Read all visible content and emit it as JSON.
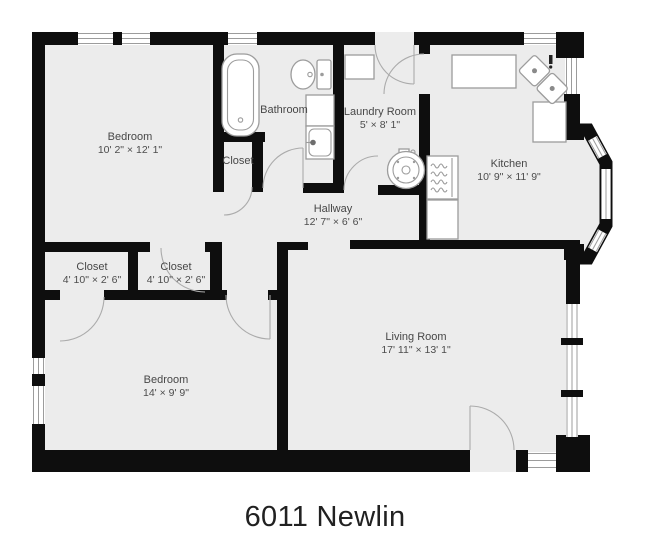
{
  "title": "6011 Newlin",
  "rooms": {
    "bedroom1": {
      "name": "Bedroom",
      "dims": "10' 2\" × 12' 1\""
    },
    "bathroom": {
      "name": "Bathroom",
      "dims": ""
    },
    "closet_top": {
      "name": "Closet",
      "dims": ""
    },
    "laundry": {
      "name": "Laundry Room",
      "dims": "5' × 8' 1\""
    },
    "kitchen": {
      "name": "Kitchen",
      "dims": "10' 9\" × 11' 9\""
    },
    "hallway": {
      "name": "Hallway",
      "dims": "12' 7\" × 6' 6\""
    },
    "closet_left": {
      "name": "Closet",
      "dims": "4' 10\" × 2' 6\""
    },
    "closet_mid": {
      "name": "Closet",
      "dims": "4' 10\" × 2' 6\""
    },
    "bedroom2": {
      "name": "Bedroom",
      "dims": "14' × 9' 9\""
    },
    "living": {
      "name": "Living Room",
      "dims": "17' 11\" × 13' 1\""
    }
  },
  "fixtures": [
    "bathtub",
    "toilet",
    "vanity-sink",
    "washer",
    "laundry-counter",
    "kitchen-counter",
    "corner-sink",
    "stove",
    "bay-window"
  ],
  "colors": {
    "wall": "#0e0e0e",
    "floor": "#ececec",
    "fixture_line": "#9c9c9c",
    "label_text": "#474747",
    "title_text": "#212121",
    "background": "#ffffff"
  }
}
